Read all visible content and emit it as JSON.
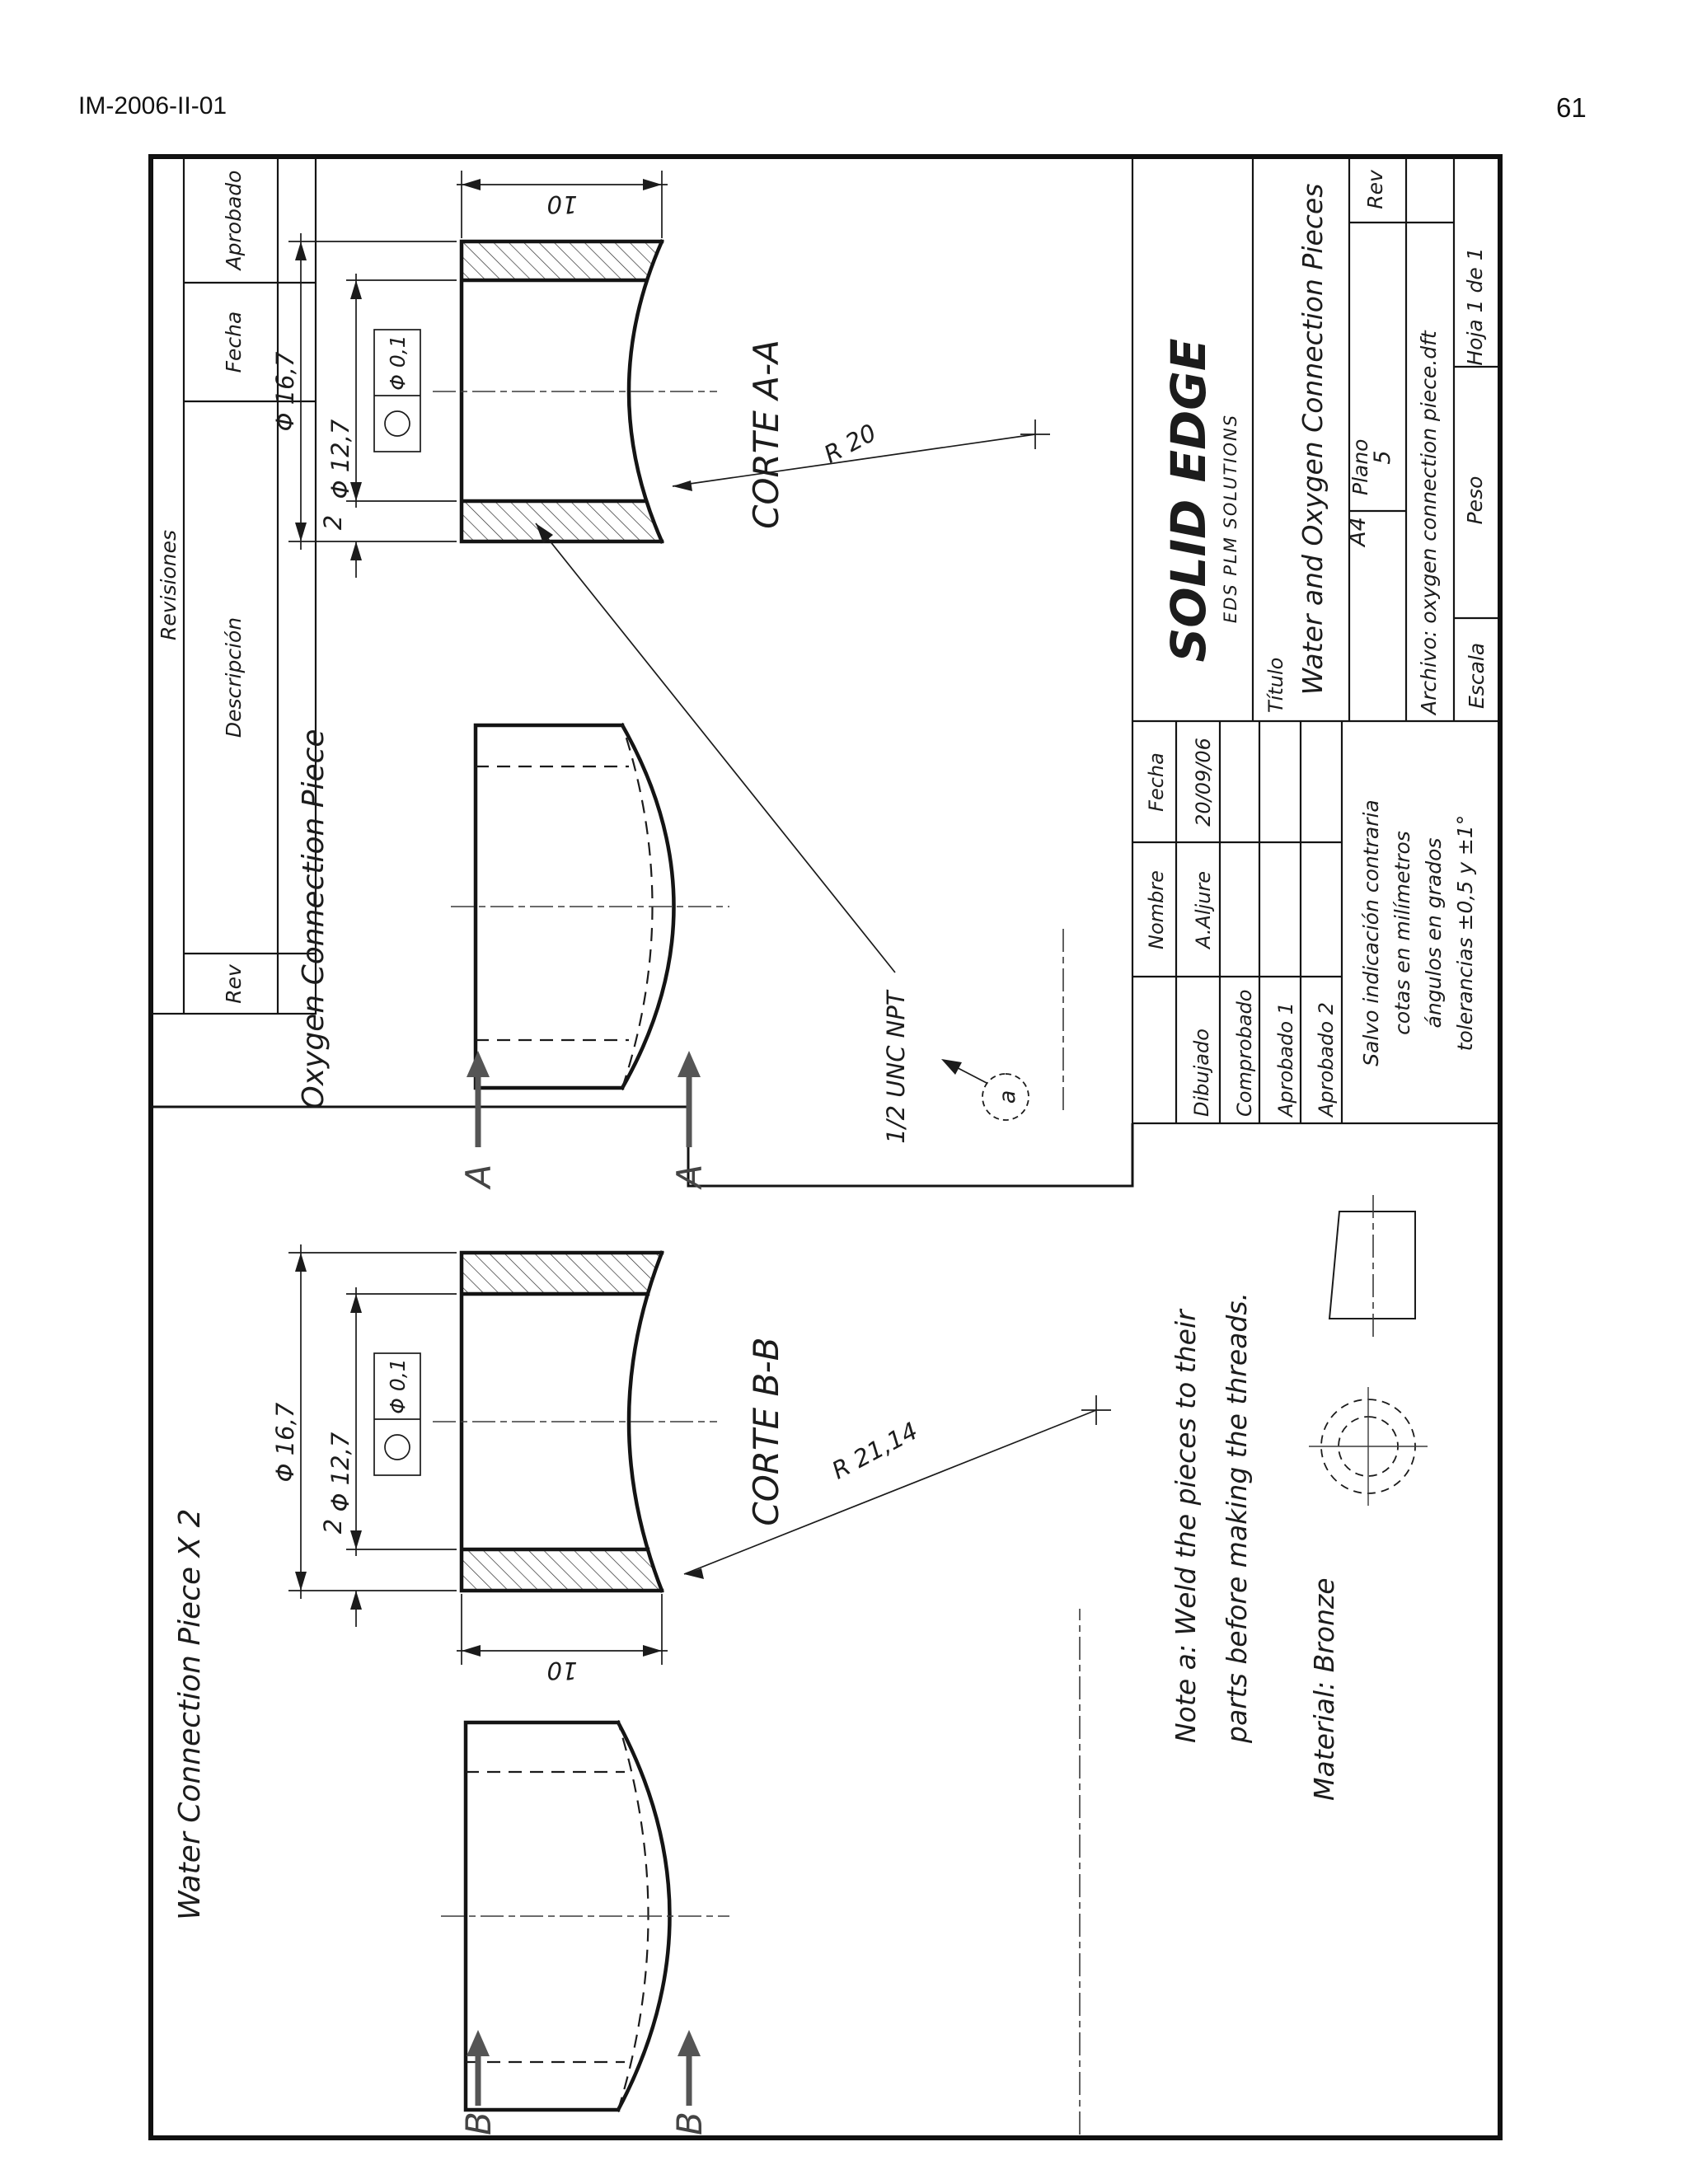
{
  "page": {
    "course_code": "IM-2006-II-01",
    "page_number": "61"
  },
  "revisions_table": {
    "title": "Revisiones",
    "col_rev": "Rev",
    "col_descripcion": "Descripción",
    "col_fecha": "Fecha",
    "col_aprobado": "Aprobado"
  },
  "title_block": {
    "brand": "SOLID EDGE",
    "brand_subtitle": "EDS PLM SOLUTIONS",
    "titulo_label": "Título",
    "titulo_value": "Water and Oxygen Connection Pieces",
    "sheet_size": "A4",
    "plano_label": "Plano",
    "plano_value": "5",
    "rev_label": "Rev",
    "archivo": "Archivo: oxygen connection piece.dft",
    "escala_label": "Escala",
    "peso_label": "Peso",
    "hoja": "Hoja 1 de 1",
    "signatures": {
      "nombre_header": "Nombre",
      "fecha_header": "Fecha",
      "row1_label": "Dibujado",
      "row2_label": "Comprobado",
      "row3_label": "Aprobado 1",
      "row4_label": "Aprobado 2",
      "dibujado_nombre": "A.Aljure",
      "dibujado_fecha": "20/09/06"
    },
    "tolerance_note": {
      "line1": "Salvo indicación contraria",
      "line2": "cotas en milímetros",
      "line3": "ángulos en grados",
      "line4": "tolerancias ±0,5 y ±1°"
    }
  },
  "oxygen_piece": {
    "label": "Oxygen Connection Piece",
    "section_label": "CORTE A-A",
    "cut_letter": "A",
    "dia_outer": "Φ 16,7",
    "dia_inner": "Φ 12,7",
    "wall": "2",
    "length": "10",
    "radius": "R 20",
    "fcf_value": "Φ 0,1",
    "thread_note": "1/2 UNC NPT",
    "weld_flag": "a"
  },
  "water_piece": {
    "label": "Water Connection Piece X 2",
    "section_label": "CORTE B-B",
    "cut_letter": "B",
    "dia_outer": "Φ 16,7",
    "dia_inner": "Φ 12,7",
    "wall": "2",
    "length": "10",
    "radius": "R 21,14",
    "fcf_value": "Φ 0,1"
  },
  "notes": {
    "note_a_line1": "Note a: Weld the pieces to their",
    "note_a_line2": "parts before making the threads.",
    "material": "Material:  Bronze"
  }
}
